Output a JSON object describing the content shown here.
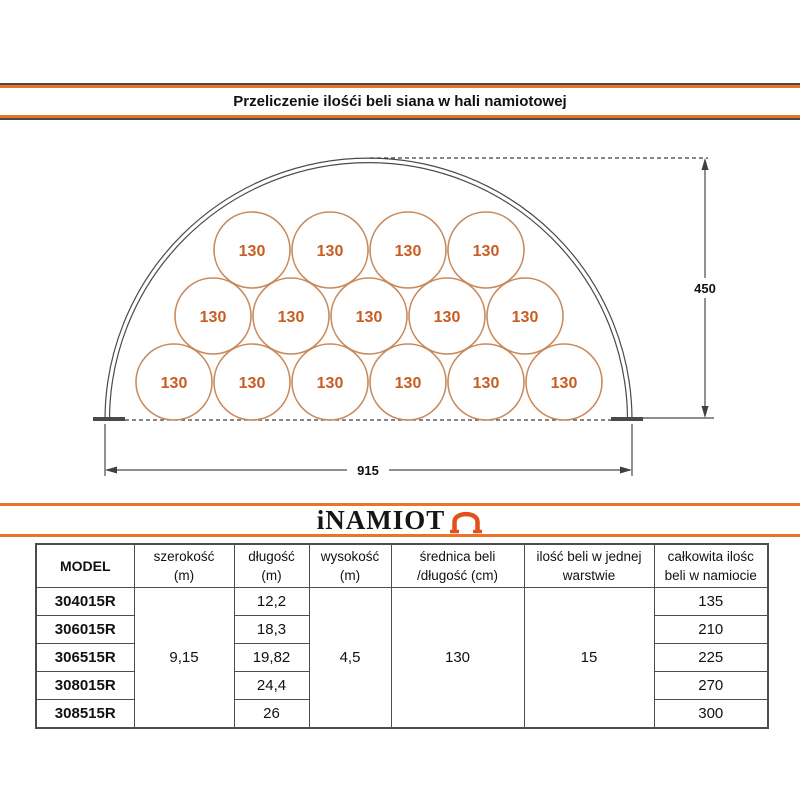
{
  "title": "Przeliczenie ilośći beli siana w hali namiotowej",
  "diagram": {
    "bale_label": "130",
    "height_dim": "450",
    "width_dim": "915",
    "bale_rows": [
      6,
      5,
      4
    ],
    "bale_total": 15
  },
  "logo": {
    "text": "iNAMIOT",
    "icon": "tent-arch-icon"
  },
  "colors": {
    "accent_orange": "#e8752a",
    "logo_orange": "#e34f1d",
    "bale_stroke": "#c98a5c",
    "bale_number": "#c75d22",
    "line_dark": "#4a4a4a"
  },
  "table": {
    "headers": {
      "model": "MODEL",
      "szerokosc_1": "szerokość",
      "szerokosc_2": "(m)",
      "dlugosc_1": "długość",
      "dlugosc_2": "(m)",
      "wysokosc_1": "wysokość",
      "wysokosc_2": "(m)",
      "srednica_1": "średnica beli",
      "srednica_2": "/długość (cm)",
      "ilosc_1": "ilość beli w jednej",
      "ilosc_2": "warstwie",
      "calkowita_1": "całkowita ilośc",
      "calkowita_2": "beli w namiocie"
    },
    "models": [
      "304015R",
      "306015R",
      "306515R",
      "308015R",
      "308515R"
    ],
    "szerokosc": "9,15",
    "dlugosc": [
      "12,2",
      "18,3",
      "19,82",
      "24,4",
      "26"
    ],
    "wysokosc": "4,5",
    "srednica": "130",
    "ilosc_warstwa": "15",
    "calkowita": [
      "135",
      "210",
      "225",
      "270",
      "300"
    ]
  }
}
